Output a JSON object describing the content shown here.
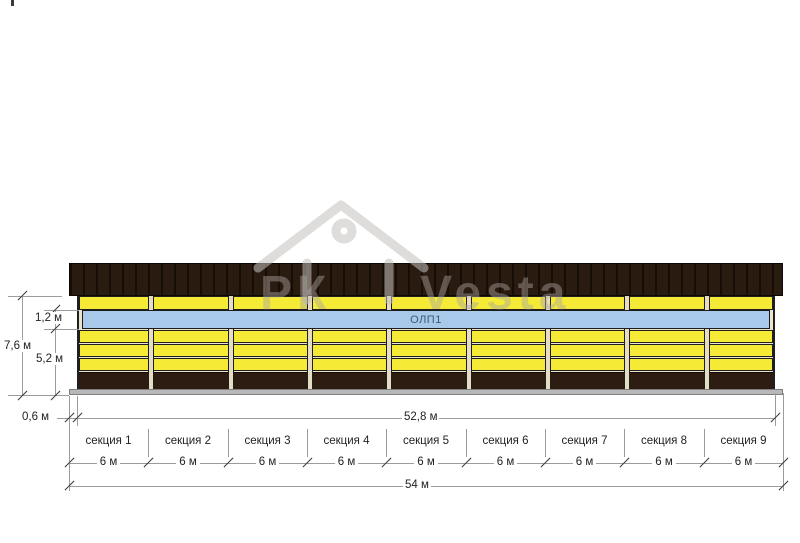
{
  "watermark": {
    "text_left": "РК",
    "text_right": "Vesta",
    "icon": "house-outline-icon"
  },
  "building": {
    "band_label": "ОЛП1",
    "colors": {
      "roof": "#2a1b10",
      "panel_yellow": "#f5eb37",
      "band_blue": "#a8c9e9",
      "plinth": "#2d1c11",
      "base_gray": "#b8b8b8"
    }
  },
  "dimensions": {
    "height_total": "7,6 м",
    "band_height": "1,2 м",
    "lower_height": "5,2 м",
    "overhang": "0,6 м",
    "wall_length": "52,8 м",
    "total_length": "54 м",
    "section_width": "6 м",
    "sections": [
      {
        "label": "секция 1"
      },
      {
        "label": "секция 2"
      },
      {
        "label": "секция 3"
      },
      {
        "label": "секция 4"
      },
      {
        "label": "секция 5"
      },
      {
        "label": "секция 6"
      },
      {
        "label": "секция 7"
      },
      {
        "label": "секция 8"
      },
      {
        "label": "секция 9"
      }
    ]
  }
}
